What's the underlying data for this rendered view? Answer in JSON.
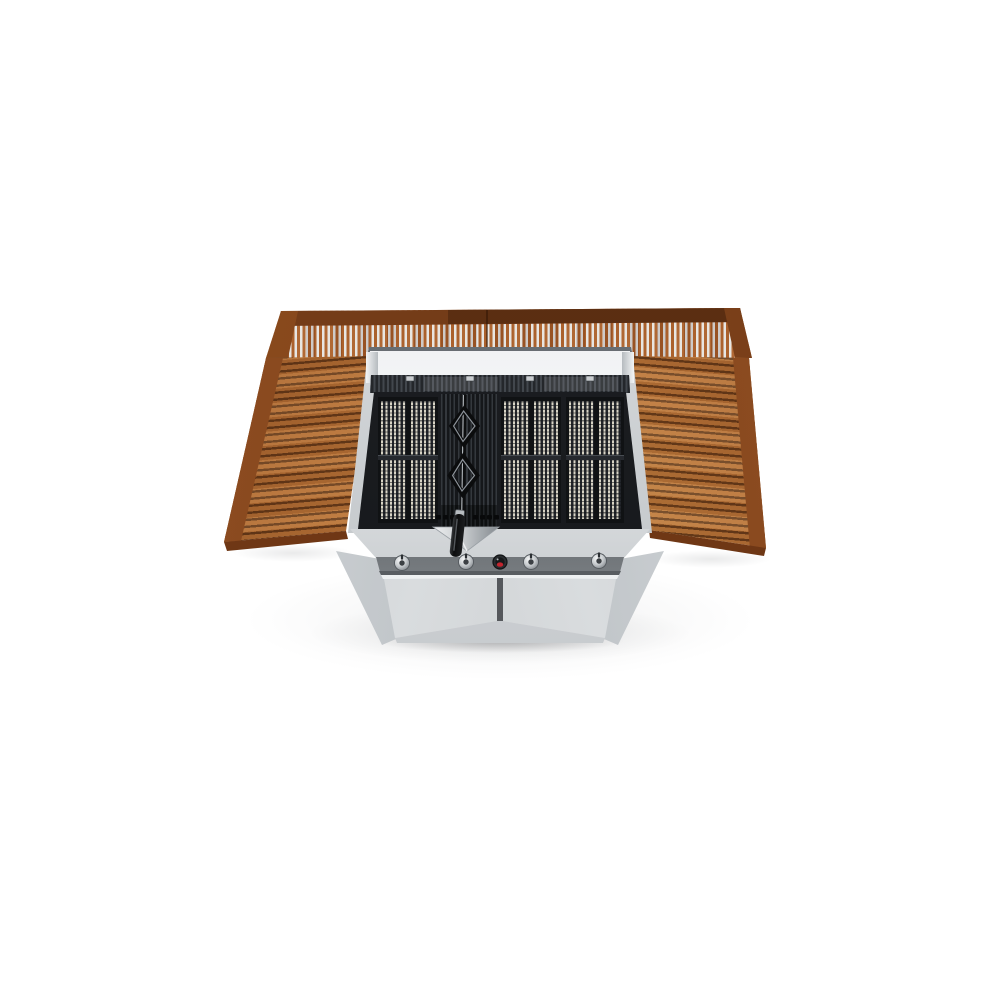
{
  "meta": {
    "aria_label": "Product photo: stainless steel gas barbecue grill with open top, wooden slatted back shelf and two wooden side tables on a white background",
    "scene_type": "studio product photograph",
    "view": "elevated front three-quarter view"
  },
  "scene": {
    "background_color": "#ffffff",
    "object": "freestanding gas barbecue grill cart with teak wood surround"
  },
  "colors": {
    "wood_light": "#c68a46",
    "wood_mid": "#a85c28",
    "wood_dark": "#6e3713",
    "wood_rail": "#5d2e11",
    "steel_light": "#f2f4f5",
    "steel_mid": "#c6cacd",
    "steel_dark": "#83898e",
    "grate_iron": "#17191b",
    "grate_rod_cream": "#d8d4c5",
    "igniter_red": "#c2252e",
    "handle_black": "#101113",
    "shadow_gray": "#6a6d71"
  },
  "wood_surround": {
    "back_shelf_slats": "vertical",
    "side_tables": 2,
    "side_table_slats": "horizontal"
  },
  "grill": {
    "lid_state": "open",
    "grate_rod_panels": 3,
    "cast_iron_center_sections": 1,
    "rotisserie_diamond_handles": 2,
    "tool_handles": 1,
    "burner_knobs": 4,
    "igniter_buttons": 1,
    "cabinet_doors": 2,
    "vent_slots": 8
  }
}
